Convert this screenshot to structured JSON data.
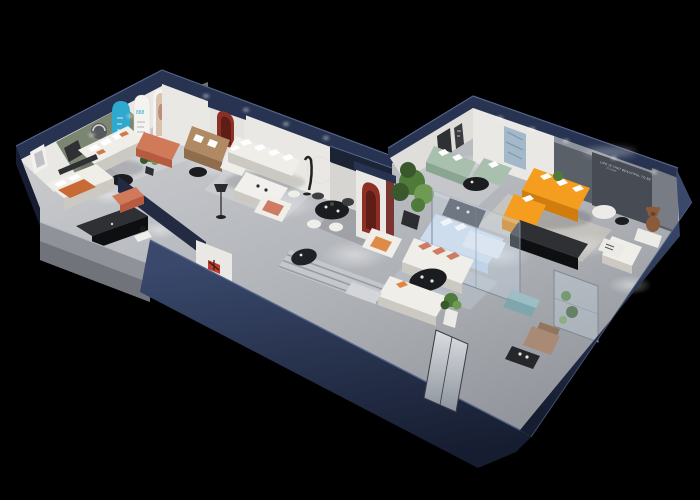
{
  "colors": {
    "bg": "#000000",
    "navy": "#273350",
    "navyDeep": "#161d30",
    "navyTop": "#39486b",
    "navyEdge": "#53648c",
    "grayCap": "#8f9399",
    "grayCapDark": "#63666c",
    "wallWhite": "#e9e8e4",
    "wallShade": "#d2d0cb",
    "olive": "#7c8572",
    "oliveDoor": "#6b785e",
    "accent": "#5a6068",
    "accentDark": "#474c54",
    "cove": "#9aa0a8",
    "teal": "#2fa9cd",
    "archRed": "#8e2f26",
    "archRedDark": "#5e1d16",
    "maroon": "#7c3430",
    "logoRed": "#c0392b",
    "sofaWhite": "#efeee9",
    "sofaShadow": "#cbc9c2",
    "tan": "#b08a63",
    "tanDark": "#8f6c4b",
    "terracotta": "#b85a40",
    "terraLight": "#d07a5a",
    "orange": "#f59d1f",
    "orangeDark": "#d17d0d",
    "sage": "#a9c0af",
    "sageDark": "#8aa591",
    "salmon": "#cf7a62",
    "ink": "#1b1c1f",
    "inkDeep": "#0e0f11",
    "charcoal": "#2e3034",
    "plant": "#4e7a3a",
    "plantDark": "#39592c",
    "plantLight": "#6f9a52",
    "rug": "#d6d7da",
    "rugWarm": "#d9d3c6",
    "runner": "#c7cacf",
    "runnerLine": "#8d9197",
    "bear": "#8a5a3b",
    "tealOtto": "#7fa6ad",
    "brown": "#a98a74",
    "photo": "#d9c3b0",
    "artBlue": "#a3b9c9",
    "glass": "#cfe0ee",
    "glassEdge": "#7d8a99",
    "bedBlue": "#ccdcec",
    "blueCab": "#dfe8f2",
    "white": "#ffffff",
    "textDim": "#d8dbe0"
  },
  "decals": {
    "accent_wall_line1": "LIFE IS THAT BEAUTIFUL TO BE",
    "accent_wall_line2": "AT HOME",
    "arch_panel_numbers": "888"
  }
}
